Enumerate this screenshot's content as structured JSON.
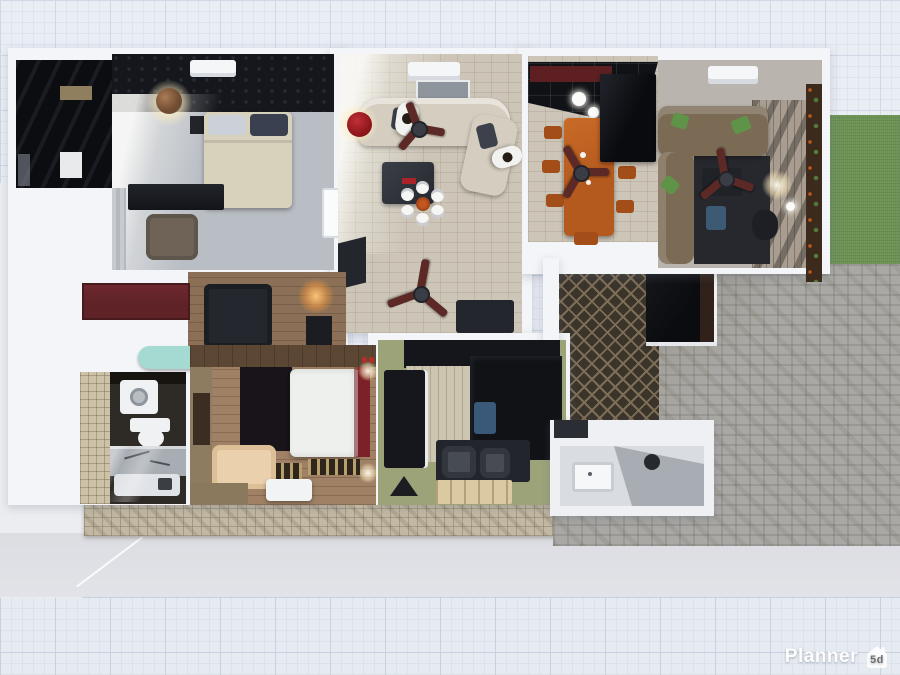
{
  "watermark": {
    "brand": "Planner",
    "badge": "5d"
  },
  "palette": {
    "grid_bg": "#e9edf4",
    "grid_line": "#c7d1e0",
    "grid_line2": "#dbe2ec",
    "ground": "#ecedf1",
    "driveway": "#e2e3e8",
    "wall": "#f3f5f8",
    "stone": "#c2b8a3",
    "lawn": "#6b9254",
    "lawn_dark": "#5f854b",
    "paver": "#a9a8a4",
    "paver_brown": "#9a9489",
    "patio": "#3b342b",
    "patio_line": "#7d6e58",
    "deck": "#a89d90",
    "black_room": "#0b0d11",
    "gloss": "#101216",
    "darkwall": "#15171d",
    "floor_gray": "#b9bdc4",
    "floor_tile": "#cdc6b8",
    "wood_mid": "#8b7057",
    "wood_warm": "#a08165",
    "wood_light": "#ccc6b0",
    "kitchen_green": "#9ca379",
    "bed_cream": "#d6d2bb",
    "pillow_light": "#ccd0d8",
    "pillow_dark": "#3a4050",
    "sofa_cream": "#d5cec0",
    "cushion": "#3c414b",
    "family_sofa": "#7b6a54",
    "pillow_green": "#5f9448",
    "darkfurn": "#23262c",
    "maroon": "#5e2227",
    "bed_maroon": "#7c2127",
    "fan": "#5c2926",
    "beam": "#5d1f21",
    "orange": "#b45a1e",
    "orange2": "#a34d19",
    "tan": "#8d7c5f",
    "brown_wall": "#5b4733",
    "headboard": "#181419",
    "beige_chair": "#ead0ad",
    "white_furn": "#f2f3f5",
    "fixture": "#f0f1f3",
    "tile_beige": "#cdc2a8",
    "bath_floor": "#2e2a26",
    "counter": "#a7adb3",
    "teal": "#a5dad2",
    "lamp_red": "#8c151b",
    "ball": "#6f4b31",
    "blue": "#3d5a75",
    "shirt": "#f2f2f0",
    "hair": "#241c15",
    "wm_text": "#fdfdfd",
    "wm_badge_text": "#6f6f6f"
  }
}
